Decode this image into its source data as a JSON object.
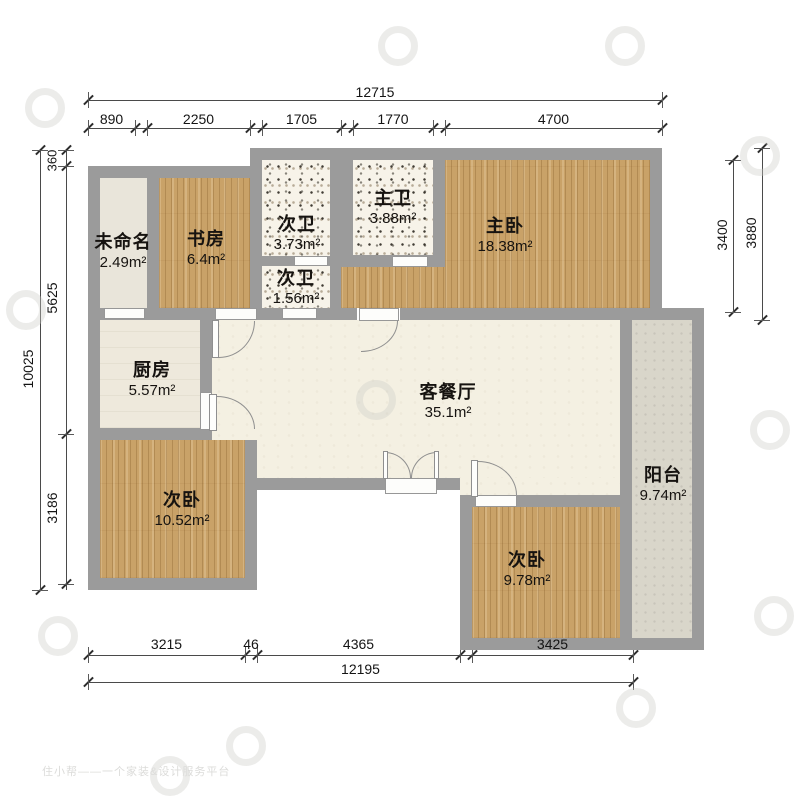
{
  "watermark": {
    "text": "住小帮——一个家装&设计服务平台"
  },
  "rooms": {
    "unnamed": {
      "name": "未命名",
      "area": "2.49m²"
    },
    "study": {
      "name": "书房",
      "area": "6.4m²"
    },
    "bath_second_upper": {
      "name": "次卫",
      "area": "3.73m²"
    },
    "bath_second_lower": {
      "name": "次卫",
      "area": "1.56m²"
    },
    "bath_master": {
      "name": "主卫",
      "area": "3.88m²"
    },
    "master": {
      "name": "主卧",
      "area": "18.38m²"
    },
    "kitchen": {
      "name": "厨房",
      "area": "5.57m²"
    },
    "living": {
      "name": "客餐厅",
      "area": "35.1m²"
    },
    "bedroom_left": {
      "name": "次卧",
      "area": "10.52m²"
    },
    "bedroom_right": {
      "name": "次卧",
      "area": "9.78m²"
    },
    "balcony": {
      "name": "阳台",
      "area": "9.74m²"
    }
  },
  "dims": {
    "top": {
      "overall": "12715",
      "segments": [
        "890",
        "2250",
        "1705",
        "1770",
        "4700"
      ]
    },
    "bottom": {
      "overall": "12195",
      "segments": [
        "3215",
        "46",
        "4365",
        "3425"
      ]
    },
    "left": {
      "overall": "10025",
      "segments": [
        "360",
        "5625",
        "3186"
      ]
    },
    "right": {
      "segments": [
        "3400",
        "3880"
      ]
    }
  }
}
